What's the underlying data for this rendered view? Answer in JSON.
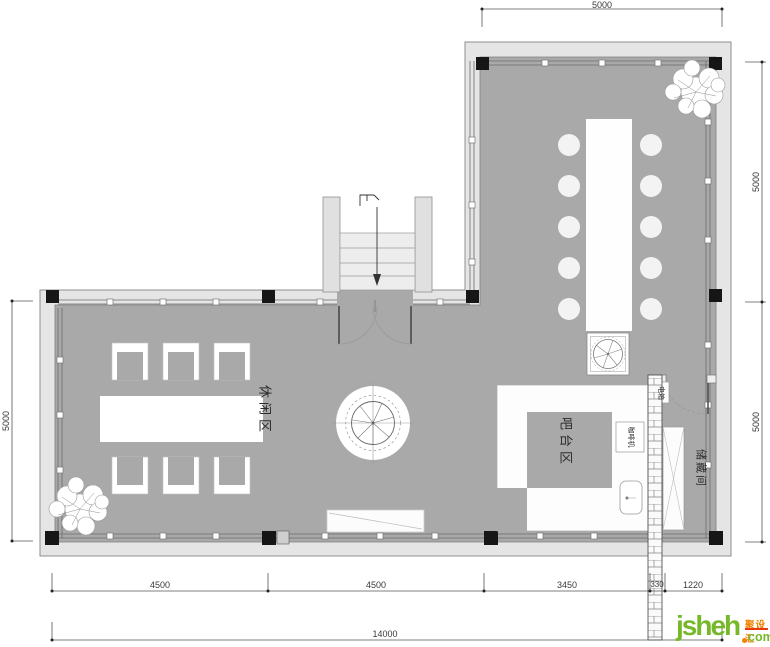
{
  "rooms": {
    "leisure": "休闲区",
    "bar": "吧台区",
    "storage": "储藏间"
  },
  "equipment": {
    "coffee_machine": "咖啡机",
    "electric_box": "电箱"
  },
  "dimensions": {
    "top": "5000",
    "right_upper": "5000",
    "right_lower": "5000",
    "left": "5000",
    "bottom_row1": [
      "4500",
      "4500",
      "3450",
      "330",
      "1220"
    ],
    "bottom_total": "14000"
  },
  "logo": {
    "name": "jsheh",
    "cn": "聚设汇",
    "tld": "com",
    "green": "#76b82a",
    "orange": "#f08300",
    "red": "#e8380d"
  },
  "colors": {
    "floor": "#a9a9a9",
    "wall_band": "#e5e5e5",
    "column": "#161616",
    "furniture": "#ffffff"
  }
}
